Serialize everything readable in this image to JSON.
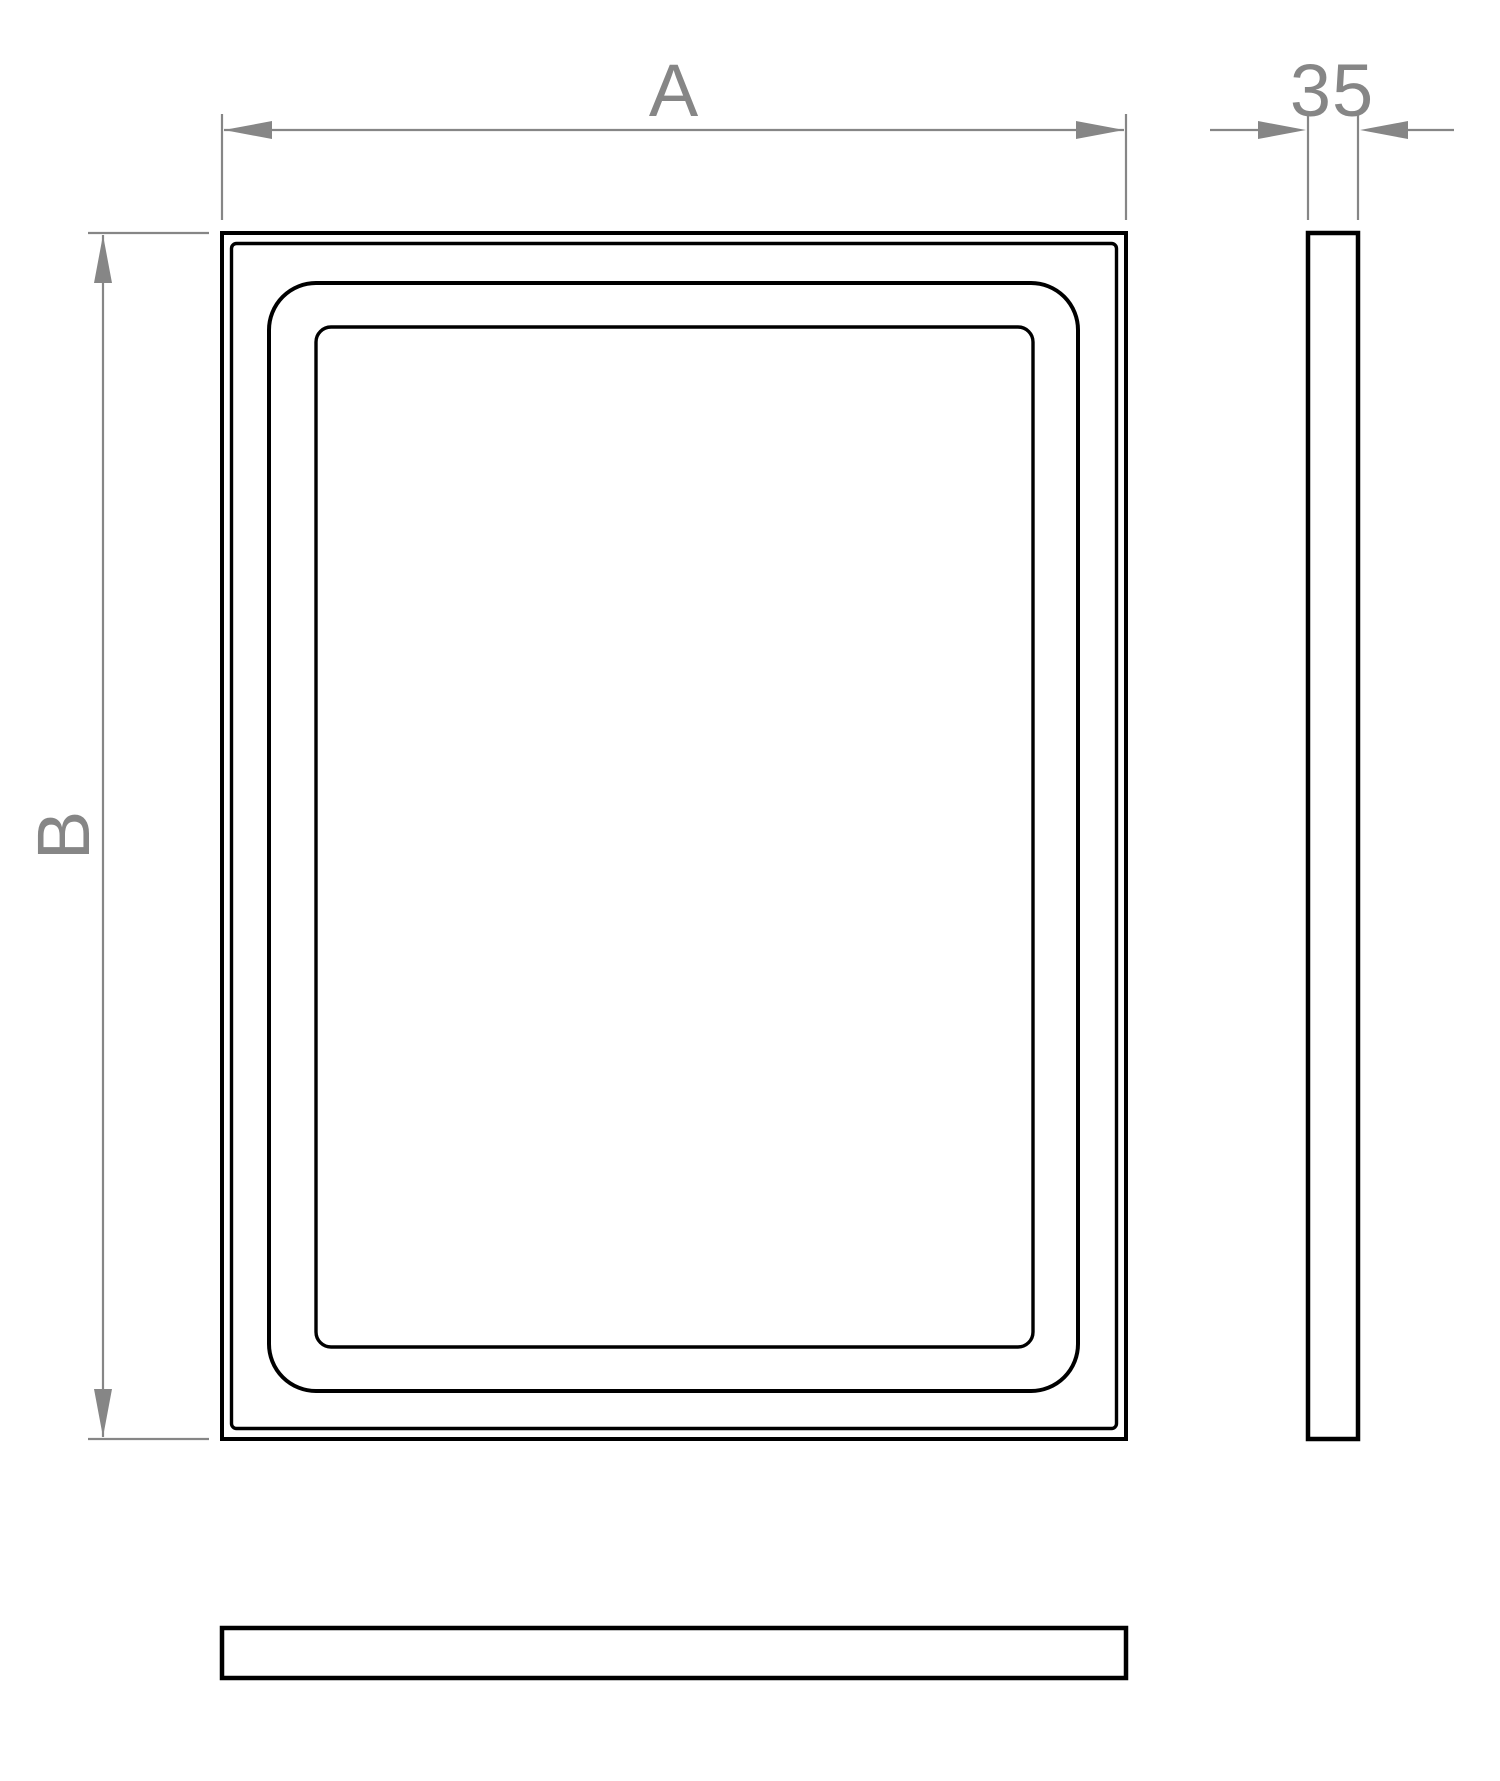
{
  "drawing": {
    "title": "rectangular panel dimension drawing",
    "views": {
      "front": {
        "name": "front view",
        "outlines": [
          "outer edge",
          "face step line",
          "recess outer line",
          "recess inner line"
        ]
      },
      "side": {
        "name": "side profile view"
      },
      "bottom": {
        "name": "bottom profile view"
      }
    },
    "dimensions": {
      "width": {
        "label": "A",
        "orientation": "horizontal",
        "applies_to": "front view overall width"
      },
      "height": {
        "label": "B",
        "orientation": "vertical",
        "applies_to": "front view overall height"
      },
      "depth": {
        "label": "35",
        "orientation": "horizontal",
        "applies_to": "side view thickness"
      }
    }
  },
  "colors": {
    "outline": "#000000",
    "dimension": "#868686",
    "background": "#ffffff"
  }
}
